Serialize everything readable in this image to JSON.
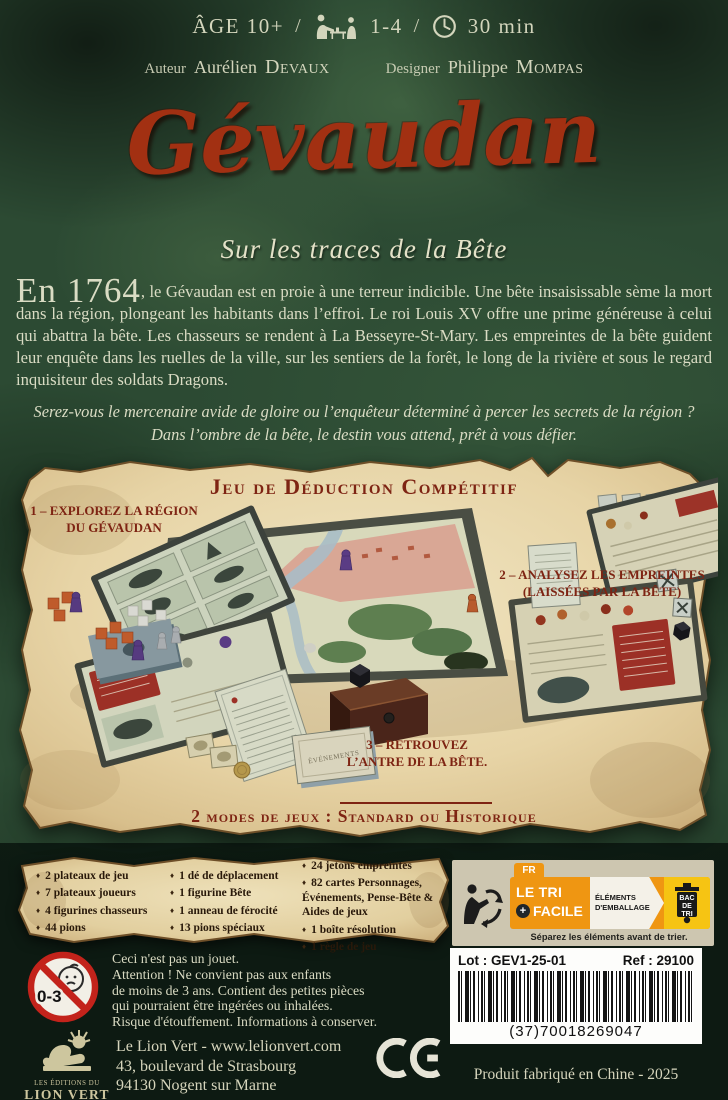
{
  "header": {
    "age": "ÂGE 10+",
    "sep1": "/",
    "players": "1-4",
    "sep2": "/",
    "time": "30 min",
    "author_label": "Auteur",
    "author_first": "Aurélien",
    "author_last": "Devaux",
    "designer_label": "Designer",
    "designer_first": "Philippe",
    "designer_last": "Mompas"
  },
  "title": {
    "main": "Gévaudan",
    "subtitle": "Sur les traces de la Bête"
  },
  "intro": {
    "lead": "En 1764",
    "body": ", le Gévaudan est en proie à une terreur indicible. Une bête insaisissable sème la mort dans la région, plongeant les habitants dans l’effroi. Le roi Louis XV offre une prime généreuse à celui qui abattra la bête. Les chasseurs se rendent à La Besseyre-St-Mary. Les empreintes de la bête guident leur enquête dans les ruelles de la ville, sur les sentiers de la forêt, le long de la rivière et sous le regard inquisiteur des soldats Dragons.",
    "quote_line1": "Serez-vous le mercenaire avide de gloire ou l’enquêteur déterminé à percer les secrets de la région ?",
    "quote_line2": "Dans l’ombre de la bête, le destin vous attend, prêt à vous défier."
  },
  "showcase": {
    "heading": "Jeu de Déduction Compétitif",
    "callout1_line1": "1 – EXPLOREZ LA RÉGION",
    "callout1_line2": "DU GÉVAUDAN",
    "callout2_line1": "2 – ANALYSEZ LES EMPREINTES",
    "callout2_line2": "(LAISSÉES PAR LA BÊTE)",
    "callout3_line1": "3 – RETROUVEZ",
    "callout3_line2": "L’ANTRE DE LA BÊTE.",
    "modes": "2 modes de jeux : Standard ou Historique",
    "deck_label": "ÉVÉNEMENTS"
  },
  "components": {
    "col1": [
      "2 plateaux de jeu",
      "7 plateaux joueurs",
      "4 figurines chasseurs",
      "44 pions"
    ],
    "col2": [
      "1 dé de déplacement",
      "1 figurine Bête",
      "1 anneau de férocité",
      "13 pions spéciaux"
    ],
    "col3_0": "24 jetons empreintes",
    "col3_1": "82 cartes Personnages, Événements, Pense-Bête & Aides de jeux",
    "col3_2": "1 boîte résolution",
    "col3_3": "1 règle de jeu"
  },
  "recycling": {
    "country": "FR",
    "tri_line1": "LE TRI",
    "tri_plus": "+",
    "tri_line2": "FACILE",
    "elements_line1": "ÉLÉMENTS",
    "elements_line2": "D'EMBALLAGE",
    "bin_line1": "BAC",
    "bin_line2": "DE",
    "bin_line3": "TRI",
    "footer": "Séparez les éléments avant de trier."
  },
  "product": {
    "lot": "Lot : GEV1-25-01",
    "ref": "Ref : 29100",
    "barcode_number": "(37)70018269047",
    "made_in": "Produit fabriqué en Chine - 2025"
  },
  "warning": {
    "badge": "0-3",
    "line1": "Ceci n'est pas un jouet.",
    "line2": "Attention !  Ne convient pas aux enfants",
    "line3": "de moins de 3 ans. Contient des petites pièces",
    "line4": "qui pourraient être ingérées ou inhalées.",
    "line5": "Risque d'étouffement. Informations à conserver."
  },
  "publisher": {
    "logo_line1": "LES ÉDITIONS DU",
    "logo_line2": "LION VERT",
    "address1": "Le Lion Vert - www.lelionvert.com",
    "address2": "43, boulevard de Strasbourg",
    "address3": "94130 Nogent sur Marne"
  }
}
